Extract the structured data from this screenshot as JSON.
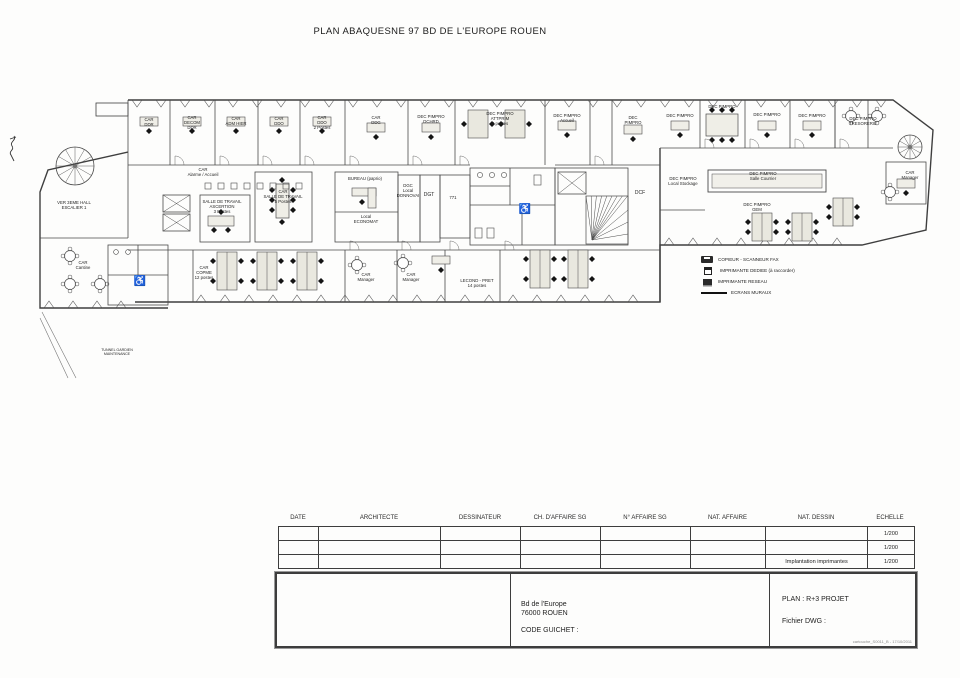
{
  "page": {
    "title": "PLAN ABAQUESNE 97 BD DE L'EUROPE ROUEN"
  },
  "plan": {
    "labels": [
      {
        "x": 149,
        "y": 121,
        "lines": [
          "CAR",
          "DDR"
        ]
      },
      {
        "x": 192,
        "y": 119,
        "lines": [
          "CAR",
          "DECOM",
          "DDR"
        ]
      },
      {
        "x": 236,
        "y": 120,
        "lines": [
          "CAR",
          "ADM HIER"
        ]
      },
      {
        "x": 279,
        "y": 120,
        "lines": [
          "CAR",
          "DDO"
        ]
      },
      {
        "x": 322,
        "y": 119,
        "lines": [
          "CAR",
          "DDO",
          "2 Postes"
        ]
      },
      {
        "x": 376,
        "y": 119,
        "lines": [
          "CAR",
          "DDG"
        ]
      },
      {
        "x": 431,
        "y": 118,
        "lines": [
          "DEC PIMPRO",
          "DCHRD"
        ]
      },
      {
        "x": 500,
        "y": 115,
        "lines": [
          "DEC PIMPRO",
          "ATTPRIM",
          "4 postes"
        ]
      },
      {
        "x": 567,
        "y": 117,
        "lines": [
          "DEC PIMPRO",
          "Accueil"
        ]
      },
      {
        "x": 633,
        "y": 119,
        "lines": [
          "DEC",
          "PIMPRO"
        ]
      },
      {
        "x": 680,
        "y": 117,
        "lines": [
          "DEC PIMPRO"
        ]
      },
      {
        "x": 722,
        "y": 108,
        "lines": [
          "DEC PIMPRO"
        ]
      },
      {
        "x": 767,
        "y": 116,
        "lines": [
          "DEC PIMPRO"
        ]
      },
      {
        "x": 812,
        "y": 117,
        "lines": [
          "DEC PIMPRO"
        ]
      },
      {
        "x": 863,
        "y": 120,
        "lines": [
          "DEC PIMPRO",
          "TRESORERIE"
        ]
      },
      {
        "x": 203,
        "y": 171,
        "lines": [
          "CAR",
          "Alarme / Accueil"
        ]
      },
      {
        "x": 222,
        "y": 203,
        "lines": [
          "SALLE DE TRAVAIL",
          "ASCERTION",
          "3 Postes"
        ]
      },
      {
        "x": 283,
        "y": 193,
        "lines": [
          "CAR",
          "SALLE DE TRAVAIL",
          "5 Postes"
        ]
      },
      {
        "x": 365,
        "y": 180,
        "lines": [
          "BUREAU (paprio)"
        ]
      },
      {
        "x": 366,
        "y": 218,
        "lines": [
          "Local",
          "ECONOMAT"
        ]
      },
      {
        "x": 408,
        "y": 187,
        "lines": [
          "DGC",
          "Local",
          "DONNOVAI"
        ]
      },
      {
        "x": 429,
        "y": 196,
        "lines": [
          "DGT"
        ],
        "size": 5
      },
      {
        "x": 453,
        "y": 199,
        "lines": [
          "771"
        ]
      },
      {
        "x": 640,
        "y": 194,
        "lines": [
          "DCF"
        ],
        "size": 5
      },
      {
        "x": 683,
        "y": 180,
        "lines": [
          "DEC PIMPRO",
          "Local Stockage"
        ]
      },
      {
        "x": 763,
        "y": 175,
        "lines": [
          "DEC PIMPRO",
          "Salle Courrier"
        ]
      },
      {
        "x": 757,
        "y": 206,
        "lines": [
          "DEC PIMPRO",
          "GEM"
        ]
      },
      {
        "x": 910,
        "y": 174,
        "lines": [
          "CAR",
          "Manager"
        ]
      },
      {
        "x": 74,
        "y": 204,
        "lines": [
          "VER 3EME HALL",
          "ESCALIER 1"
        ]
      },
      {
        "x": 83,
        "y": 264,
        "lines": [
          "CAR",
          "Cantine"
        ]
      },
      {
        "x": 204,
        "y": 269,
        "lines": [
          "CAR",
          "COPME",
          "12 postes"
        ]
      },
      {
        "x": 366,
        "y": 276,
        "lines": [
          "CAR",
          "Manager"
        ]
      },
      {
        "x": 411,
        "y": 276,
        "lines": [
          "CAR",
          "Manager"
        ]
      },
      {
        "x": 477,
        "y": 282,
        "lines": [
          "LECOND - PRET",
          "14 postes"
        ]
      },
      {
        "x": 117,
        "y": 351,
        "lines": [
          "TUNNEL GARDIEN",
          "MAINTENANCE"
        ],
        "size": 3.6
      }
    ],
    "legend": {
      "items": [
        {
          "icon": "copier-icon",
          "label": "COPIEUR - SCANNEUR FAX"
        },
        {
          "icon": "dedicated-printer-icon",
          "label": "IMPRIMANTE DEDIEE (à raccorder)"
        },
        {
          "icon": "network-printer-icon",
          "label": "IMPRIMANTE RESEAU"
        },
        {
          "icon": "wall-line-symbol",
          "label": "ECRANS MURAUX"
        }
      ]
    }
  },
  "title_block": {
    "headers": [
      "DATE",
      "ARCHITECTE",
      "DESSINATEUR",
      "CH. D'AFFAIRE SG",
      "N° AFFAIRE SG",
      "NAT. AFFAIRE",
      "NAT. DESSIN",
      "ECHELLE"
    ],
    "rows": [
      [
        "",
        "",
        "",
        "",
        "",
        "",
        "",
        "1/200"
      ],
      [
        "",
        "",
        "",
        "",
        "",
        "",
        "",
        "1/200"
      ],
      [
        "",
        "",
        "",
        "",
        "",
        "",
        "Implantation imprimantes",
        "1/200"
      ]
    ],
    "address": {
      "line1": "Bd de l'Europe",
      "line2": "76000 ROUEN",
      "guichet": "CODE GUICHET :"
    },
    "drawing": {
      "plan": "PLAN : R+3 PROJET",
      "dwg": "Fichier DWG :",
      "ref": "cartouche_S0011_B - 17/10/2011"
    }
  }
}
